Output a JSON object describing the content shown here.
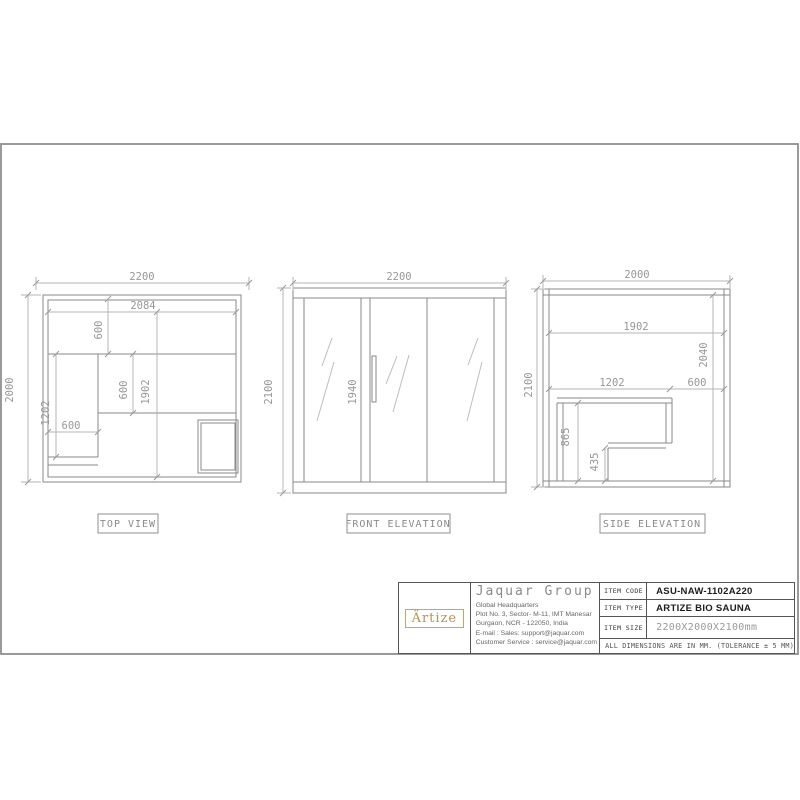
{
  "sheet": {
    "views": {
      "top": {
        "label": "TOP VIEW",
        "width": "2200",
        "depth": "2000",
        "inner_width": "2084",
        "top_bench_depth": "600",
        "inner_depth": "1902",
        "mid_depth": "600",
        "left_bench_length": "1202",
        "left_bench_width": "600"
      },
      "front": {
        "label": "FRONT ELEVATION",
        "width": "2200",
        "height": "2100",
        "door_height": "1940"
      },
      "side": {
        "label": "SIDE ELEVATION",
        "width": "2000",
        "height": "2100",
        "inner_depth": "1902",
        "inner_height": "2040",
        "bench_length": "1202",
        "clearance": "600",
        "bench_height": "865",
        "step_height": "435"
      }
    },
    "title_block": {
      "logo_text": "Ärtize",
      "company": "Jaquar Group",
      "address_lines": [
        "Global Headquarters",
        "Plot No. 3, Sector- M-11, IMT Manesar",
        "Gurgaon, NCR - 122050, India",
        "E-mail : Sales: support@jaquar.com",
        "Customer Service : service@jaquar.com"
      ],
      "rows": [
        {
          "label": "ITEM CODE",
          "value": "ASU-NAW-1102A220"
        },
        {
          "label": "ITEM TYPE",
          "value": "ARTIZE BIO SAUNA"
        },
        {
          "label": "ITEM SIZE",
          "value": "2200X2000X2100mm"
        }
      ],
      "note": "ALL DIMENSIONS ARE IN MM. (TOLERANCE ± 5 MM)"
    },
    "colors": {
      "line": "#8a8a8a",
      "dim_line": "#b6b6b6",
      "dim_text": "#979797",
      "logo_gold": "#b69153",
      "table_border": "#555555"
    }
  }
}
